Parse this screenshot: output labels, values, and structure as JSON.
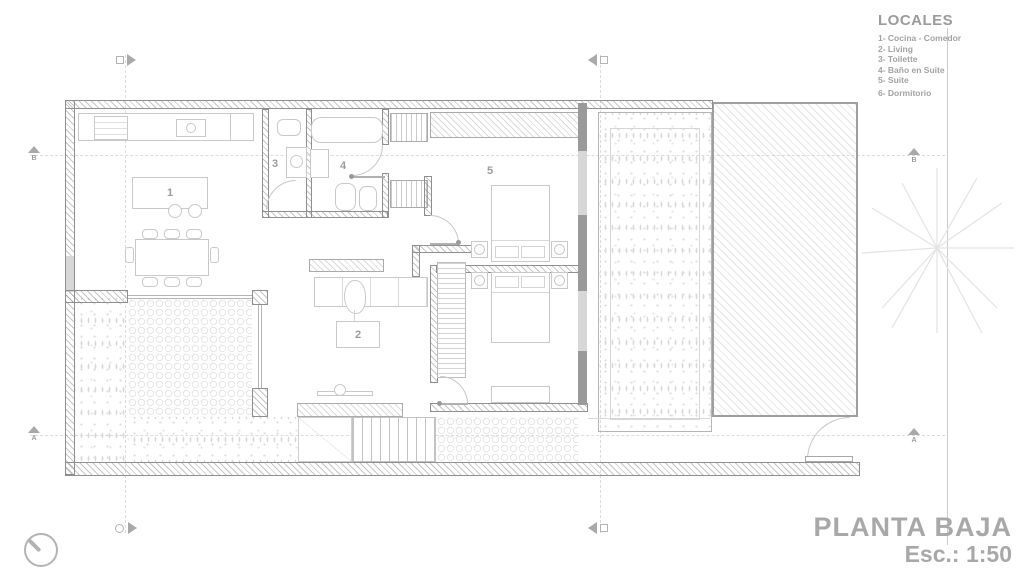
{
  "legend": {
    "title": "LOCALES",
    "items": [
      "1- Cocina - Comedor",
      "2- Living",
      "3- Toilette",
      "4- Baño en Suite",
      "5- Suite",
      "6- Dormitorio"
    ]
  },
  "title_block": {
    "name": "PLANTA BAJA",
    "scale": "Esc.: 1:50"
  },
  "room_labels": {
    "kitchen_dining": "1",
    "living": "2",
    "toilette": "3",
    "bathroom_suite": "4",
    "suite": "5",
    "bedroom": "6"
  },
  "section_markers": {
    "a": "A",
    "b": "B"
  },
  "colors": {
    "wall_line": "#8f8f8f",
    "furniture_line": "#c9c9c9",
    "label_text": "#9b9b9b",
    "title_text": "#a8a8a8",
    "hatch_line": "#c4c4c4",
    "paving_line": "#e2e2e2"
  }
}
